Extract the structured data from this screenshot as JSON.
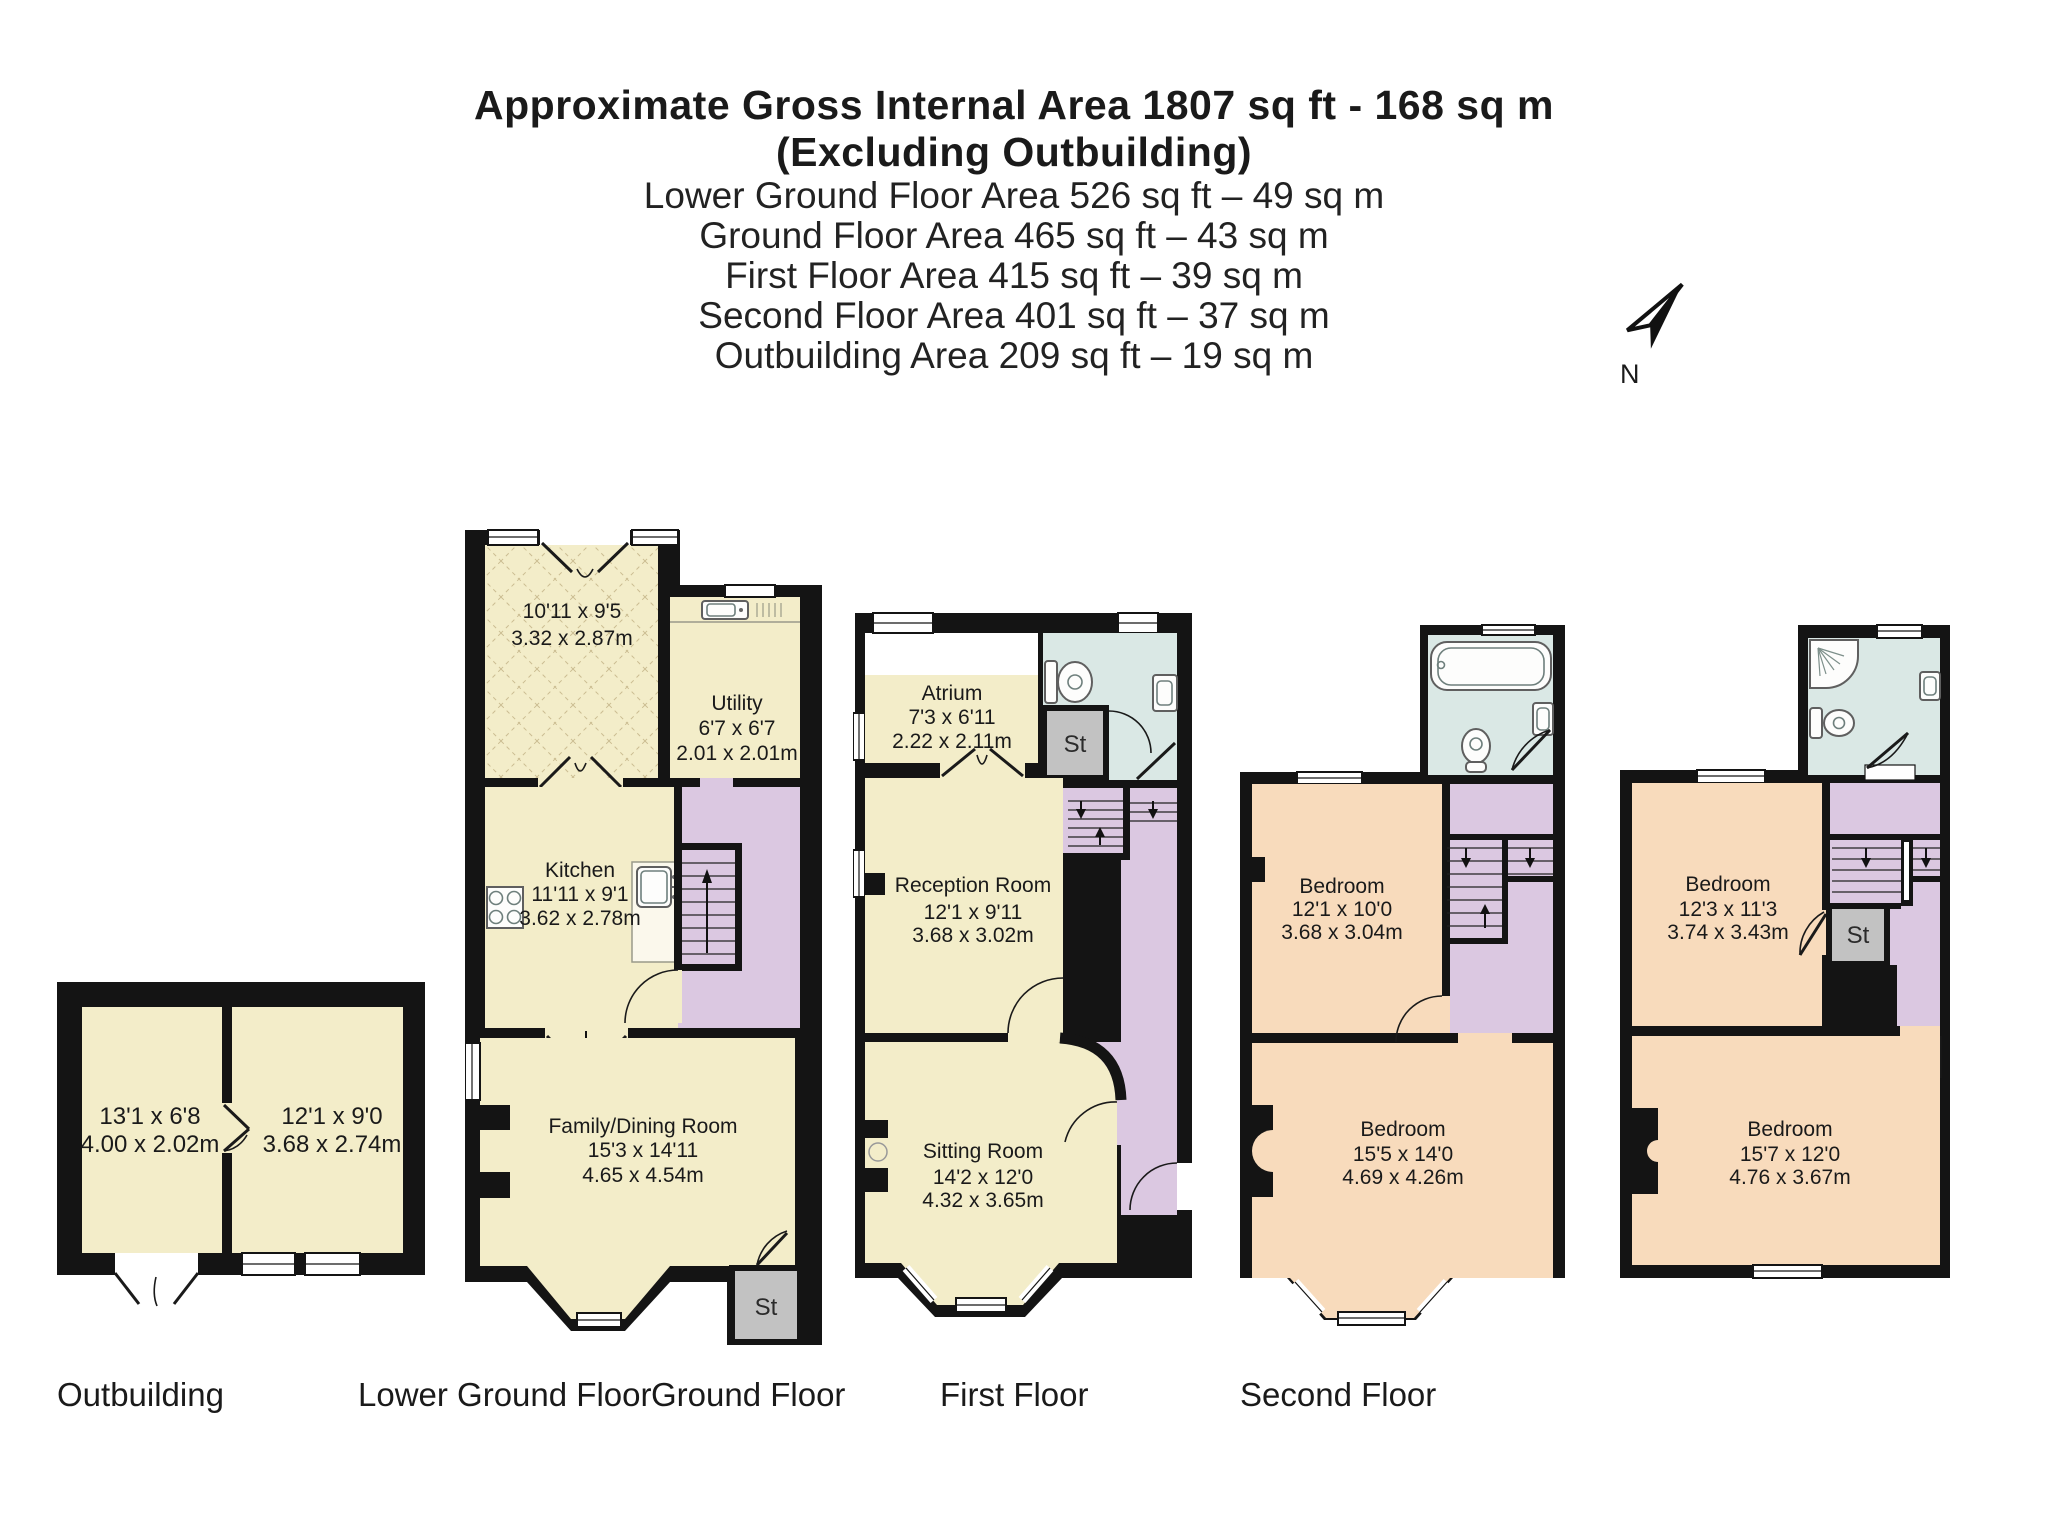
{
  "header": {
    "title_line1": "Approximate Gross Internal Area 1807 sq ft - 168 sq m",
    "title_line2": "(Excluding Outbuilding)",
    "area_lines": [
      "Lower Ground Floor Area 526 sq ft – 49 sq m",
      "Ground Floor Area 465 sq ft – 43 sq m",
      "First Floor Area 415 sq ft – 39 sq m",
      "Second Floor Area 401 sq ft – 37 sq m",
      "Outbuilding Area 209 sq ft – 19 sq m"
    ]
  },
  "compass": {
    "label": "N"
  },
  "palette": {
    "room_cream": "#F3EDC9",
    "stairs_lilac": "#DBC8E1",
    "bath_blue": "#DAE8E5",
    "bedroom_peach": "#F8DBBC",
    "storage_grey": "#C2C2C2",
    "wall_black": "#141414"
  },
  "floors": {
    "outbuilding": {
      "label": "Outbuilding",
      "room1": {
        "imperial": "13'1 x 6'8",
        "metric": "4.00 x 2.02m"
      },
      "room2": {
        "imperial": "12'1 x 9'0",
        "metric": "3.68 x 2.74m"
      }
    },
    "lower_ground": {
      "label": "Lower Ground Floor",
      "cellar": {
        "imperial": "10'11 x 9'5",
        "metric": "3.32 x 2.87m"
      },
      "utility": {
        "name": "Utility",
        "imperial": "6'7 x 6'7",
        "metric": "2.01 x 2.01m"
      },
      "kitchen": {
        "name": "Kitchen",
        "imperial": "11'11 x 9'1",
        "metric": "3.62 x 2.78m"
      },
      "family": {
        "name": "Family/Dining Room",
        "imperial": "15'3 x 14'11",
        "metric": "4.65 x 4.54m"
      },
      "st": "St"
    },
    "ground": {
      "label": "Ground Floor",
      "atrium": {
        "name": "Atrium",
        "imperial": "7'3 x 6'11",
        "metric": "2.22 x 2.11m"
      },
      "reception": {
        "name": "Reception Room",
        "imperial": "12'1 x 9'11",
        "metric": "3.68 x 3.02m"
      },
      "sitting": {
        "name": "Sitting Room",
        "imperial": "14'2 x 12'0",
        "metric": "4.32 x 3.65m"
      },
      "st": "St"
    },
    "first": {
      "label": "First Floor",
      "bedroom1": {
        "name": "Bedroom",
        "imperial": "12'1 x 10'0",
        "metric": "3.68 x 3.04m"
      },
      "bedroom2": {
        "name": "Bedroom",
        "imperial": "15'5 x 14'0",
        "metric": "4.69 x 4.26m"
      }
    },
    "second": {
      "label": "Second Floor",
      "bedroom1": {
        "name": "Bedroom",
        "imperial": "12'3 x 11'3",
        "metric": "3.74 x 3.43m"
      },
      "bedroom2": {
        "name": "Bedroom",
        "imperial": "15'7 x 12'0",
        "metric": "4.76 x 3.67m"
      },
      "st": "St"
    }
  }
}
